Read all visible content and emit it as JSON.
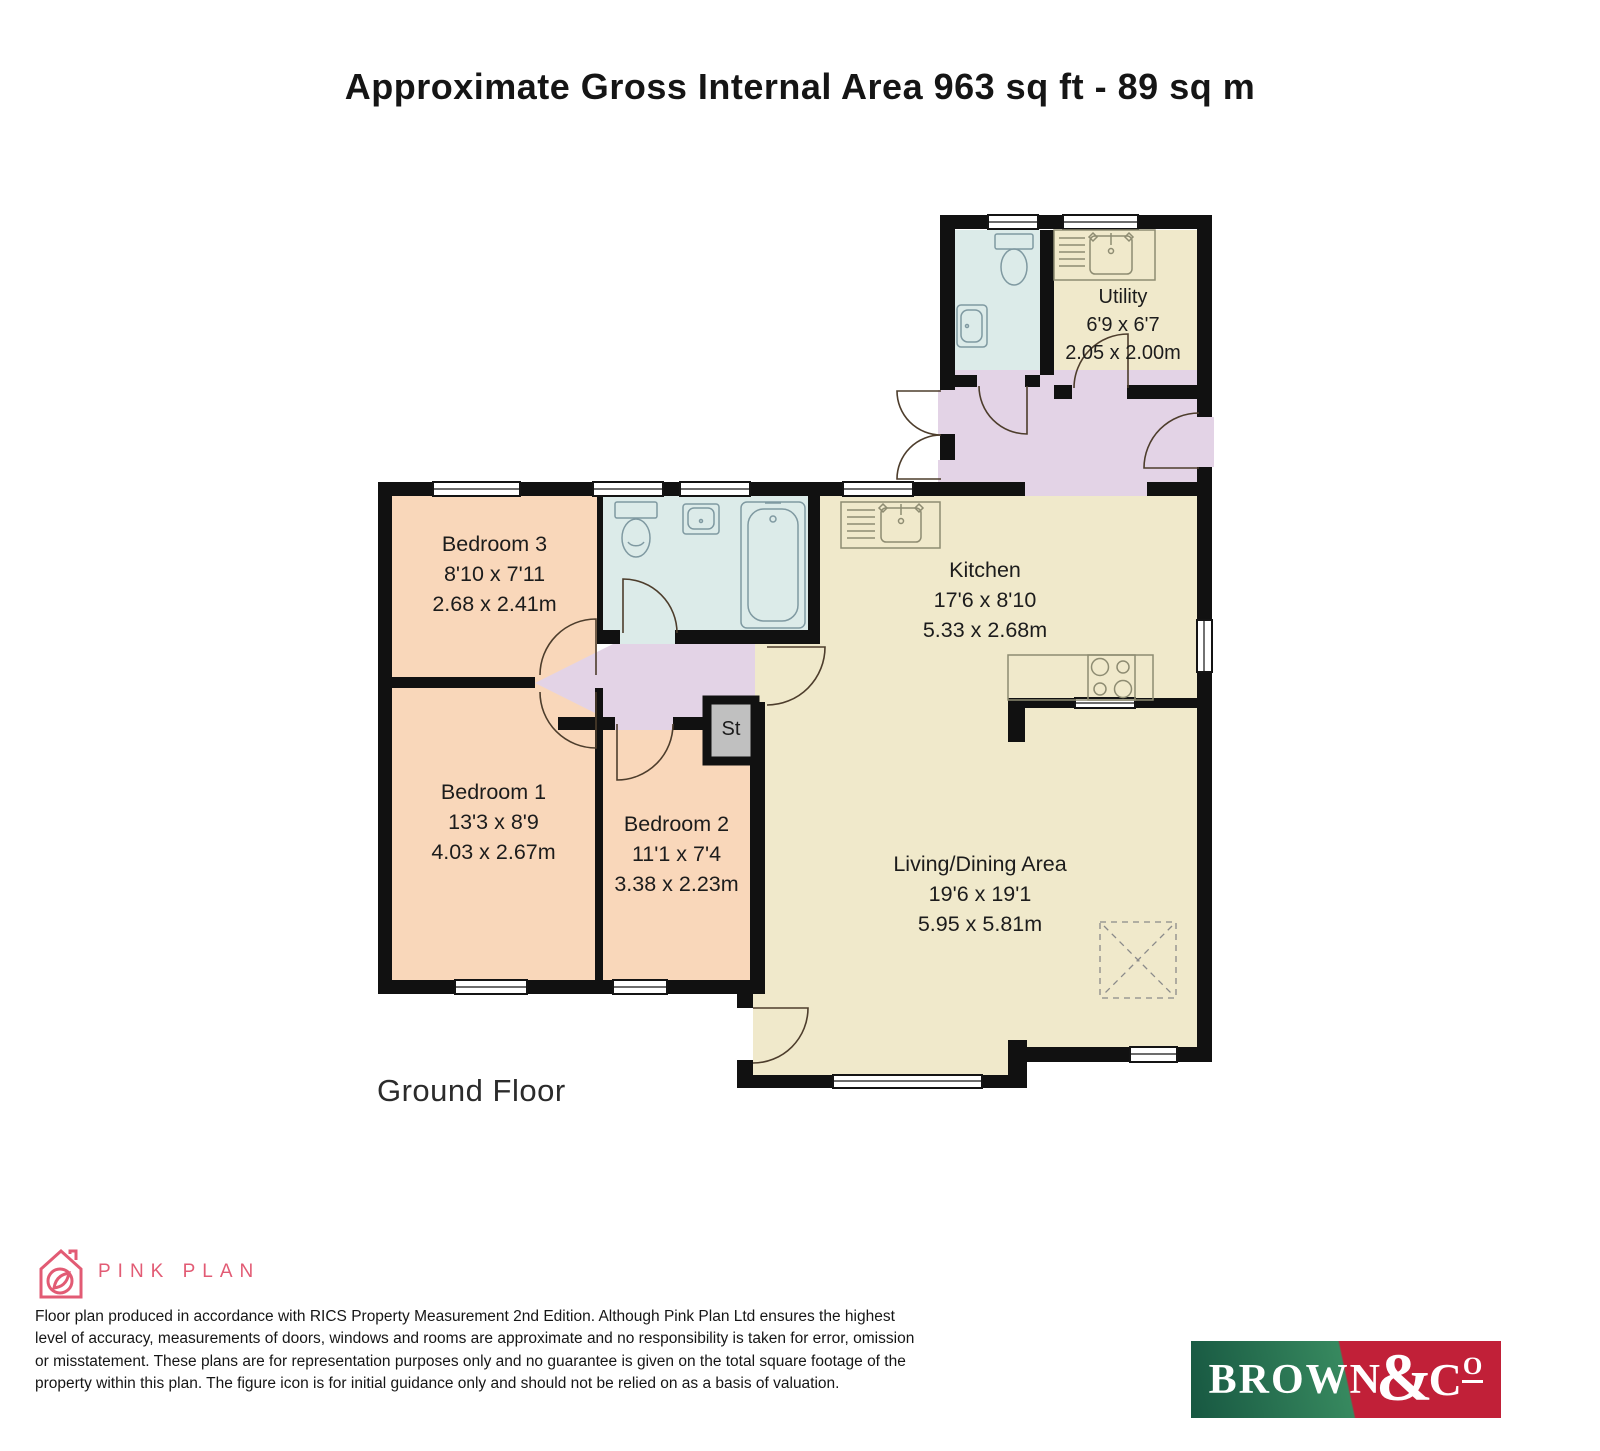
{
  "title": "Approximate Gross Internal Area 963 sq ft - 89 sq m",
  "floor_label": "Ground Floor",
  "rooms": {
    "utility": {
      "name": "Utility",
      "ft": "6'9 x 6'7",
      "m": "2.05 x 2.00m"
    },
    "bedroom3": {
      "name": "Bedroom 3",
      "ft": "8'10 x 7'11",
      "m": "2.68 x 2.41m"
    },
    "kitchen": {
      "name": "Kitchen",
      "ft": "17'6 x 8'10",
      "m": "5.33 x 2.68m"
    },
    "bedroom1": {
      "name": "Bedroom 1",
      "ft": "13'3 x 8'9",
      "m": "4.03 x 2.67m"
    },
    "bedroom2": {
      "name": "Bedroom 2",
      "ft": "11'1 x 7'4",
      "m": "3.38 x 2.23m"
    },
    "living": {
      "name": "Living/Dining Area",
      "ft": "19'6 x 19'1",
      "m": "5.95 x 5.81m"
    },
    "store": {
      "name": "St"
    }
  },
  "footer": {
    "pink_plan_label": "PINK PLAN",
    "disclaimer": "Floor plan produced in accordance with RICS Property Measurement 2nd Edition. Although Pink Plan Ltd ensures the highest\nlevel of accuracy, measurements of doors, windows and rooms are approximate and no responsibility is taken for error, omission\nor misstatement. These plans are for representation purposes only and no guarantee is given on the total square footage of the\nproperty within this plan. The figure icon is for initial guidance only and should not be relied on as a basis of valuation.",
    "brand": {
      "word": "BROWN",
      "amp": "&",
      "c": "C",
      "o": "O"
    }
  },
  "colors": {
    "wall": "#111111",
    "bedroom": "#f9d7ba",
    "kitchen": "#f0e9cb",
    "bath": "#dcebe9",
    "hall": "#e3d3e6",
    "store": "#c0c0c0",
    "pink": "#e25b74",
    "brand-green": "#175741",
    "brand-green-light": "#37895f",
    "brand-red": "#c12038"
  }
}
